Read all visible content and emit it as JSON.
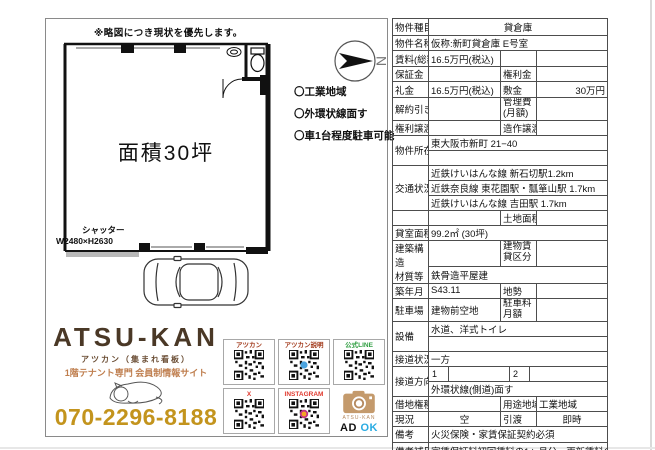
{
  "plan": {
    "note": "※略図につき現状を優先します。",
    "area_text": "面積30坪",
    "shutter_label": "シャッター",
    "shutter_size": "W2480×H2630",
    "compass": "N",
    "bullets": [
      "〇工業地域",
      "〇外環状線面す",
      "〇車1台程度駐車可能"
    ]
  },
  "brand": {
    "name": "ATSU-KAN",
    "kana": "アツカン（集まれ看板）",
    "tagline": "1階テナント専門 会員制情報サイト",
    "phone": "070-2296-8188",
    "qr_labels": [
      "アツカン",
      "アツカン説明",
      "公式LINE",
      "X",
      "INSTAGRAM"
    ],
    "camera_caption": "ATSU-KAN",
    "ad": "AD",
    "ok": "OK"
  },
  "colors": {
    "brand_brown": "#4a3826",
    "brand_tan": "#bf7e4e",
    "phone_gold": "#c3941d",
    "line_green": "#2f9e41",
    "sns_red": "#e03a2f",
    "ok_blue": "#29abe2"
  },
  "table": {
    "property_type_label": "物件種目",
    "property_type": "貸倉庫",
    "property_name_label": "物件名称",
    "property_name": "仮称:新町貸倉庫 E号室",
    "rent_label": "賃料(総額)",
    "rent": "16.5万円(税込)",
    "deposit_label": "保証金",
    "key_money_label": "権利金",
    "reikin_label": "礼金",
    "reikin": "16.5万円(税込)",
    "shikikin_label": "敷金",
    "shikikin": "30万円",
    "cancel_label": "解約引き",
    "mgmt_fee_label": "管理費\n(月額)",
    "rights_transfer_label": "権利譲渡",
    "fixtures_transfer_label": "造作譲渡",
    "location_label": "物件所在",
    "location": "東大阪市新町 21−40",
    "transport_label": "交通状況",
    "transport_lines": [
      "近鉄けいはんな線 新石切駅1.2km",
      "近鉄奈良線 東花園駅・瓢箪山駅 1.7km",
      "近鉄けいはんな線 吉田駅 1.7km"
    ],
    "land_area_label": "土地面積",
    "room_area_label": "貸室面積",
    "room_area": "99.2㎡ (30坪)",
    "structure_label": "建築構造\n材質等",
    "building_class_label": "建物賃\n貸区分",
    "structure": "鉄骨造平屋建",
    "built_label": "築年月",
    "built": "S43.11",
    "terrain_label": "地勢",
    "parking_label": "駐車場",
    "parking": "建物前空地",
    "parking_fee_label": "駐車料\n月額",
    "facilities_label": "設備",
    "facilities": "水道、洋式トイレ",
    "road_contact_label": "接道状況",
    "road_contact": "一方",
    "road_direction_label": "接道方向等",
    "road_dir_1": "1",
    "road_dir_2": "2",
    "road_note": "外環状線(側道)面す",
    "leasehold_label": "借地権種類",
    "zoning_label": "用途地域",
    "zoning": "工業地域",
    "current_label": "現況",
    "current": "空",
    "handover_label": "引渡",
    "handover": "即時",
    "remarks_label": "備考",
    "remarks": "火災保険・家賃保証契約必須",
    "remarks_sub_label": "備考補足",
    "remarks_sub": "家賃保証料初回賃料の1ヶ月分・更新賃料の10%1年更新"
  }
}
